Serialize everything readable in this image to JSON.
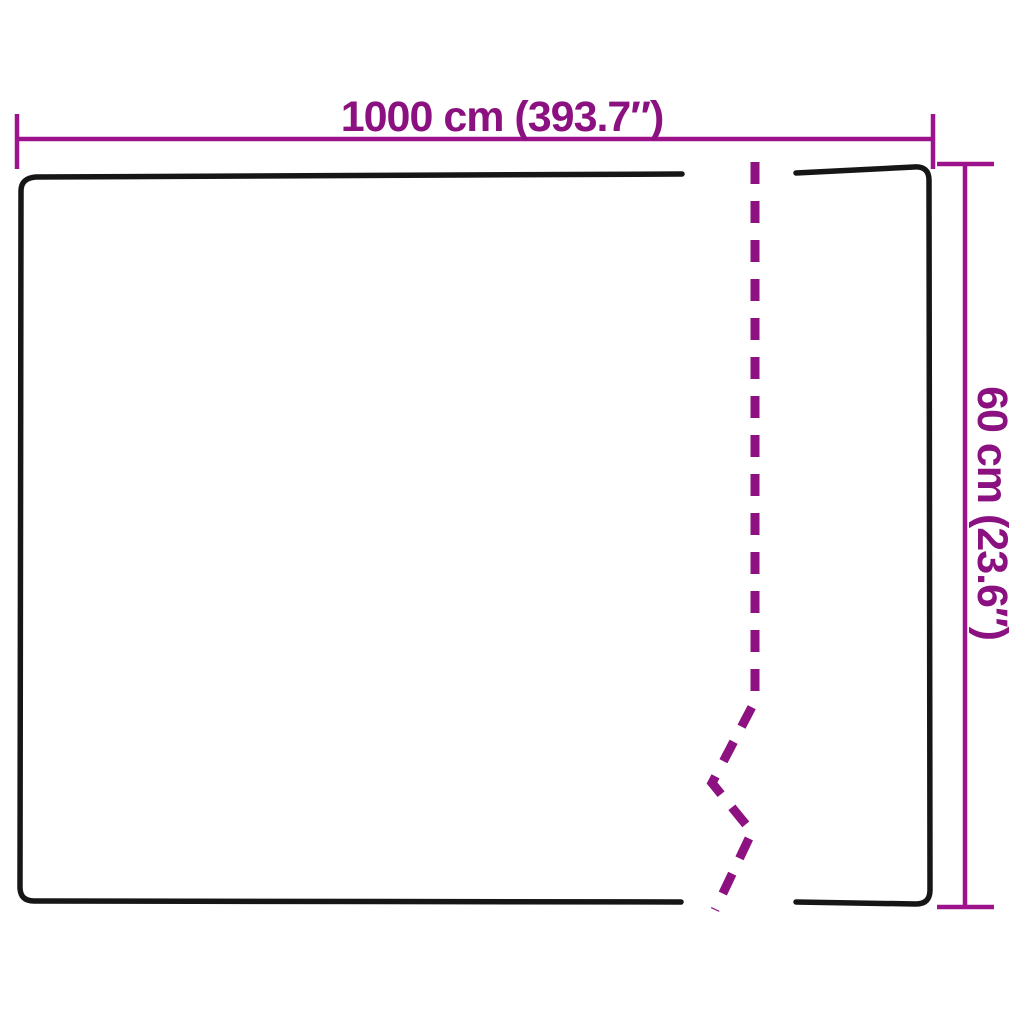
{
  "diagram": {
    "type": "product-dimension-drawing",
    "background": "#ffffff",
    "colors": {
      "outline": "#161616",
      "dimension_line": "#9c138b",
      "fold_dash": "#8d1180",
      "label_text": "#8b1080"
    },
    "dimensions": {
      "width": {
        "label": "1000 cm (393.7″)",
        "value_cm": 1000,
        "value_in": 393.7,
        "unit_metric": "cm",
        "unit_imperial": "″"
      },
      "height": {
        "label": "60 cm (23.6″)",
        "value_cm": 60,
        "value_in": 23.6,
        "unit_metric": "cm",
        "unit_imperial": "″"
      }
    }
  }
}
